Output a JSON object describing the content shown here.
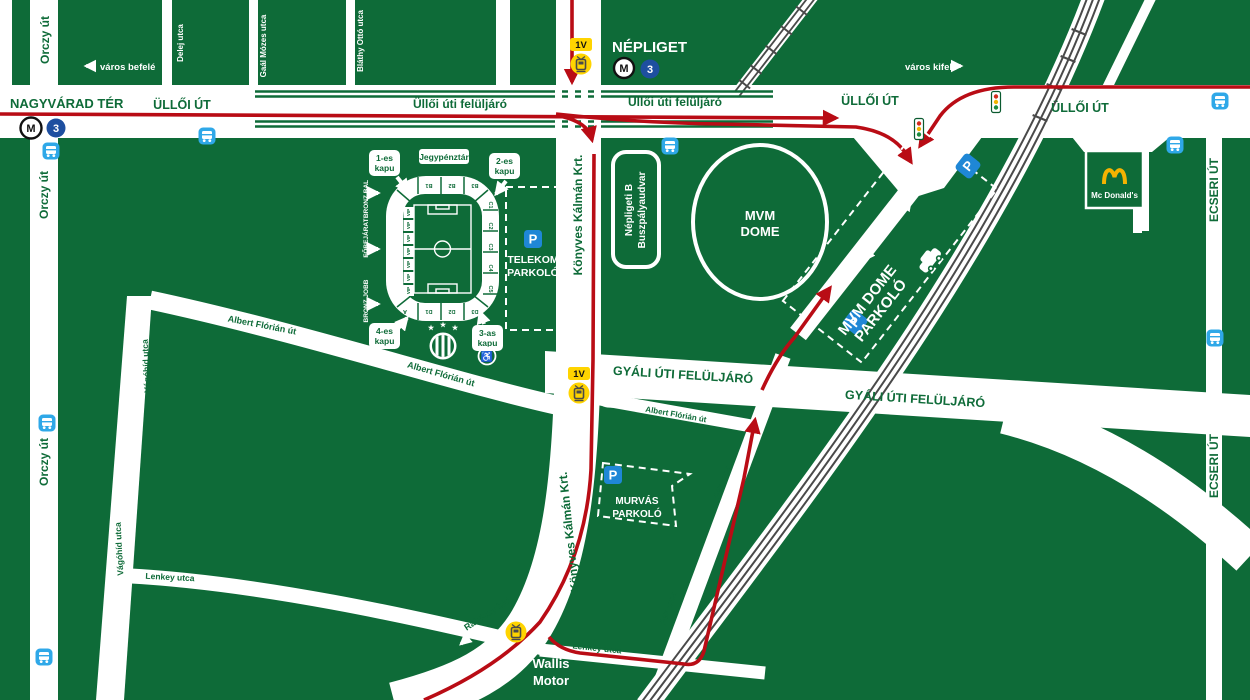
{
  "colors": {
    "background": "#0E6B38",
    "road": "#FFFFFF",
    "route_red": "#B90C15",
    "transit_yellow": "#FFD400",
    "bus_blue": "#2FA8E8",
    "parking_blue": "#1F87D6",
    "metro3_blue": "#1E4FA0",
    "mcdonalds_gold": "#F5B301",
    "railway_gray": "#4a4a4a"
  },
  "streets": {
    "nagyvarad_ter": "NAGYVÁRAD TÉR",
    "ulloi_ut": "ÜLLŐI ÚT",
    "ulloi_feluljaro": "Üllői úti felüljáró",
    "orczy_ut": "Orczy út",
    "delej_utca": "Delej utca",
    "gaal_mozes_utca": "Gaál Mózes utca",
    "blathy_otto_utca": "Bláthy Ottó utca",
    "konyves_kalman_krt": "Könyves Kálmán Krt.",
    "gyali_uti_feluljaro": "GYÁLI ÚTI FELÜLJÁRÓ",
    "albert_florian_ut": "Albert Flórián út",
    "vagohid_utca": "Vágóhíd utca",
    "lenkey_utca": "Lenkey utca",
    "fek_utca": "Fék utca",
    "ecseri_ut": "ECSERI ÚT",
    "balkan_utca": "Balkán utca",
    "rakoczy_hid": "Rákóczy híd"
  },
  "directions": {
    "inbound": "város befelé",
    "outbound": "város kifelé"
  },
  "places": {
    "nepliget": "NÉPLIGET",
    "mvm_dome_l1": "MVM",
    "mvm_dome_l2": "DOME",
    "bus_station_l1": "Népligeti B",
    "bus_station_l2": "Buszpályaudvar",
    "telekom_l1": "TELEKOM",
    "telekom_l2": "PARKOLÓ",
    "murvas_l1": "MURVÁS",
    "murvas_l2": "PARKOLÓ",
    "mvm_parking_l1": "MVM DOME",
    "mvm_parking_l2": "PARKOLÓ",
    "wallis_l1": "Wallis",
    "wallis_l2": "Motor",
    "mcdonalds": "Mc Donald's"
  },
  "transit": {
    "metro_m": "M",
    "metro_line": "3",
    "tram_line": "1V",
    "parking_p": "P"
  },
  "stadium": {
    "gate1_l1": "1-es",
    "gate1_l2": "kapu",
    "gate2_l1": "2-es",
    "gate2_l2": "kapu",
    "gate3_l1": "3-as",
    "gate3_l2": "kapu",
    "gate4_l1": "4-es",
    "gate4_l2": "kapu",
    "ticket_office": "Jegypénztár",
    "bronz_bal": "BRONZ BAL",
    "fobejarat": "FŐBEJÁRAT",
    "bronz_jobb": "BRONZ JOBB",
    "vip": "VIP",
    "sections_top": [
      "B1",
      "B2",
      "B3"
    ],
    "sections_right": [
      "C1",
      "C2",
      "C3",
      "C4",
      "C5"
    ],
    "sections_bottom": [
      "A",
      "D1",
      "D2",
      "D3"
    ]
  }
}
